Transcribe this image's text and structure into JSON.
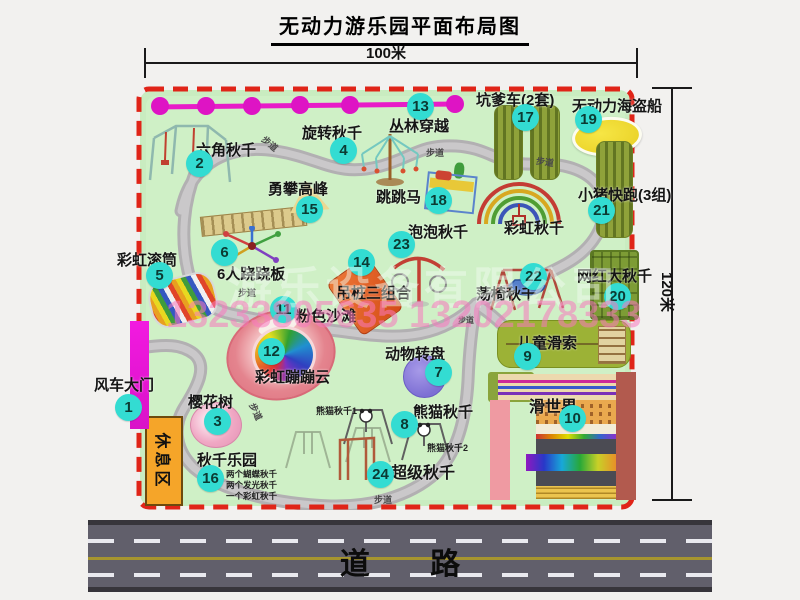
{
  "title": "无动力游乐园平面布局图",
  "dim_width": "100米",
  "dim_height": "120米",
  "road_label": "道 路",
  "path_label": "步道",
  "rest_area_label": "休息区",
  "watermark_company": "游乐设备有限公司",
  "watermark_phone": "13233805635 13202178333",
  "extra_labels": {
    "rainbow_swing": "彩虹秋千",
    "panda_swing_1": "熊猫秋千1",
    "panda_swing_2": "熊猫秋千2"
  },
  "swing_park_notes": [
    "两个蝴蝶秋千",
    "两个发光秋千",
    "一个彩虹秋千"
  ],
  "attractions": [
    {
      "num": "1",
      "name": "风车大门"
    },
    {
      "num": "2",
      "name": "六角秋千"
    },
    {
      "num": "3",
      "name": "樱花树"
    },
    {
      "num": "4",
      "name": "旋转秋千"
    },
    {
      "num": "5",
      "name": "彩虹滚筒"
    },
    {
      "num": "6",
      "name": "6人跷跷板"
    },
    {
      "num": "7",
      "name": "动物转盘"
    },
    {
      "num": "8",
      "name": "熊猫秋千"
    },
    {
      "num": "9",
      "name": "儿童滑索"
    },
    {
      "num": "10",
      "name": "滑世界"
    },
    {
      "num": "11",
      "name": "粉色沙滩"
    },
    {
      "num": "12",
      "name": "彩虹蹦蹦云"
    },
    {
      "num": "13",
      "name": "丛林穿越"
    },
    {
      "num": "14",
      "name": "吊桩三组合"
    },
    {
      "num": "15",
      "name": "勇攀高峰"
    },
    {
      "num": "16",
      "name": "秋千乐园"
    },
    {
      "num": "17",
      "name": "坑爹车(2套)"
    },
    {
      "num": "18",
      "name": "跳跳马"
    },
    {
      "num": "19",
      "name": "无动力海盗船"
    },
    {
      "num": "20",
      "name": "网红大秋千"
    },
    {
      "num": "21",
      "name": "小猪快跑(3组)"
    },
    {
      "num": "22",
      "name": "荡椅秋千"
    },
    {
      "num": "23",
      "name": "泡泡秋千"
    },
    {
      "num": "24",
      "name": "超级秋千"
    }
  ],
  "colors": {
    "park_green": "#c9ecc0",
    "border_red": "#e02418",
    "badge_cyan": "#33dcd2",
    "gate_magenta": "#ea12d8",
    "jungle_magenta": "#e81cc8",
    "road_gray": "#615f6b",
    "rest_area_orange": "#f5a529"
  }
}
